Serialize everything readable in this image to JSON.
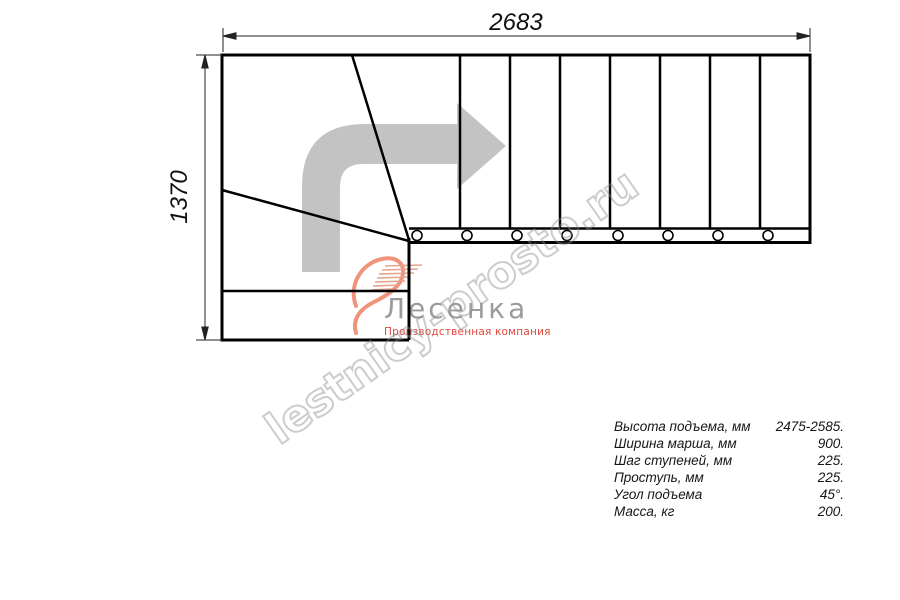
{
  "page": {
    "background": "#ffffff"
  },
  "dimensions": {
    "top_width_mm": "2683",
    "left_height_mm": "1370"
  },
  "watermark": {
    "text": "lestnicy-prosto.ru",
    "color": "#8c8c8c"
  },
  "logo": {
    "name": "Лесенка",
    "subtitle": "Производственная компания",
    "name_color": "#9b9b9b",
    "subtitle_color": "#e0473d",
    "swoosh_color": "#ef8268"
  },
  "specs": {
    "rows": [
      {
        "label": "Высота подъема, мм",
        "value": "2475-2585."
      },
      {
        "label": "Ширина марша, мм",
        "value": "900."
      },
      {
        "label": "Шаг ступеней, мм",
        "value": "225."
      },
      {
        "label": "Проступь, мм",
        "value": "225."
      },
      {
        "label": "Угол подъема",
        "value": "45°."
      },
      {
        "label": "Масса, кг",
        "value": "200."
      }
    ]
  },
  "drawing": {
    "description": "Plan view of L-shaped (90-degree turn) staircase with winder steps",
    "straight_treads": 8,
    "winder_treads": 3,
    "balusters": 8,
    "line_color": "#000000",
    "direction_arrow_color": "#c3c3c3"
  }
}
